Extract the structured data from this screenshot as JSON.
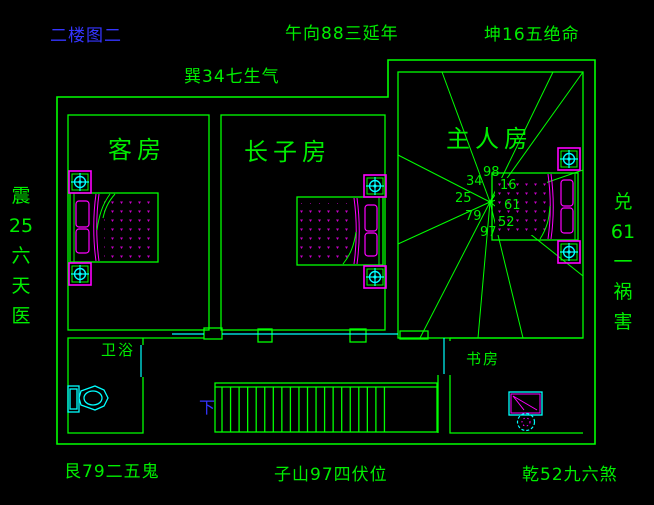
{
  "title": {
    "text": "二楼图二"
  },
  "compass_labels": {
    "upper_left": "巽34七生气",
    "top_center": "午向88三延年",
    "top_right": "坤16五绝命",
    "left_vertical": [
      "震",
      "25",
      "六",
      "天",
      "医"
    ],
    "right_vertical": [
      "兑",
      "61",
      "一",
      "祸",
      "害"
    ],
    "bottom_left": "艮79二五鬼",
    "bottom_center": "子山97四伏位",
    "bottom_right": "乾52九六煞"
  },
  "rooms": {
    "guest": "客房",
    "eldest_son": "长子房",
    "master": "主人房",
    "bathroom": "卫浴",
    "study": "书房"
  },
  "stairs": {
    "down_label": "下"
  },
  "star": {
    "values": [
      "34",
      "98",
      "16",
      "25",
      "61",
      "79",
      "52",
      "97"
    ]
  },
  "colors": {
    "wall_green": "#00ff00",
    "text_green": "#00ee00",
    "cyan": "#00ffff",
    "magenta": "#ff00ff",
    "dot_magenta": "#c800c8",
    "blue": "#3535ff"
  }
}
